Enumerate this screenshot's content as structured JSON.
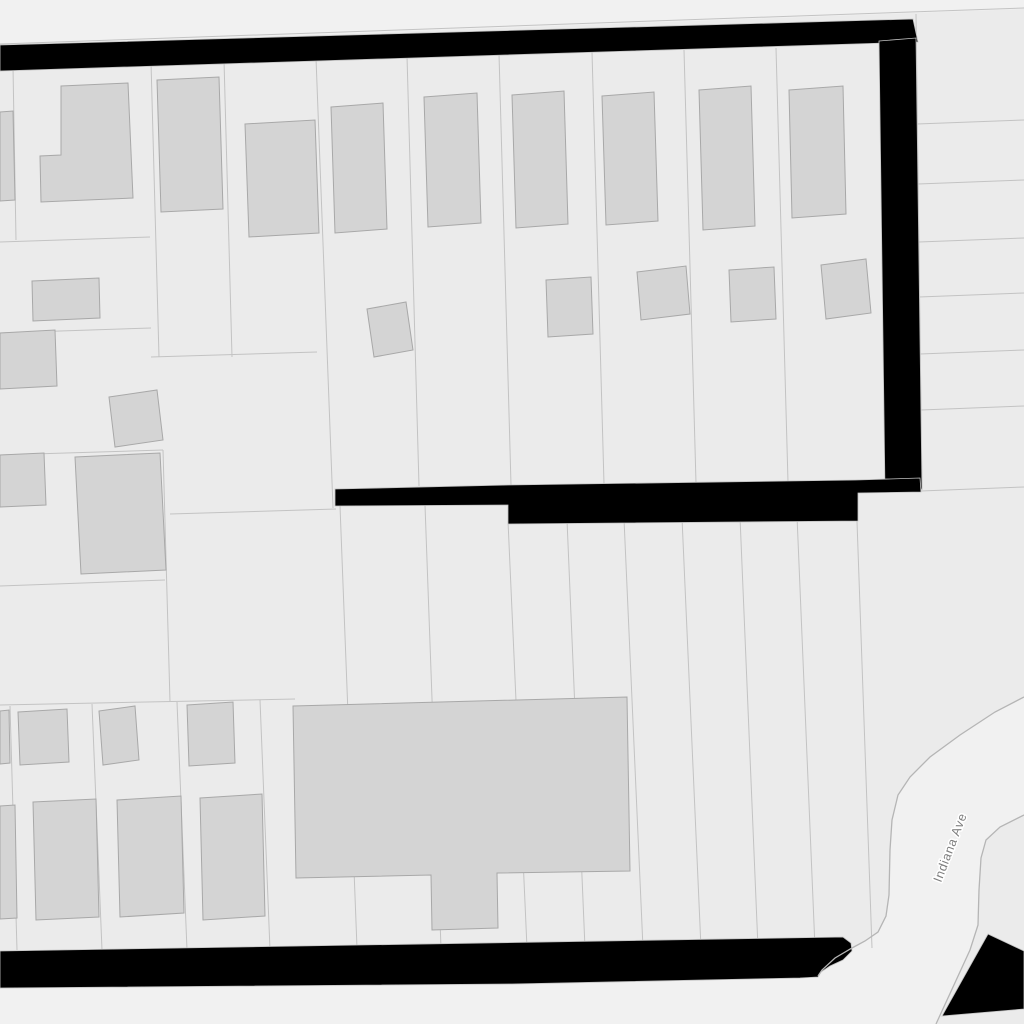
{
  "map": {
    "colors": {
      "background": "#f1f1f1",
      "parcel_fill": "#ebebeb",
      "parcel_line": "#c3c3c3",
      "building_fill": "#d4d4d4",
      "building_line": "#a8a8a8",
      "blocked_fill": "#000000",
      "blocked_edge": "#c3c3c3",
      "road_edge": "#b5b5b5",
      "label_color": "#7e7e7e",
      "label_halo": "#ffffff"
    },
    "street_label": {
      "text": "Indiana Ave",
      "x": 954,
      "y": 849,
      "rotation": -69,
      "font_size": 12.5,
      "letter_spacing": 0.7
    },
    "blocks": [
      {
        "name": "parcel-block-main",
        "points": "0,46 1024,9 1024,697 995,712 960,735 930,757 910,777 898,795 892,820 890,850 889,895 886,916 878,932 865,941 852,948 835,958 822,970 818,976 800,978 512,985 0,989"
      },
      {
        "name": "parcel-block-east-of-road",
        "points": "1024,815 1000,827 986,840 981,858 979,890 978,925 970,950 936,1024 1024,1024"
      }
    ],
    "parcel_lines": [
      "0,44 1024,8",
      "916,14 922,490",
      "917,124 1024,120",
      "918,184 1024,180",
      "919,242 1024,238",
      "919,297 1024,293",
      "920,354 1024,350",
      "921,410 1024,406",
      "921,491 1024,487",
      "13,67 16,240",
      "151,62 159,357",
      "224,60 232,357",
      "316,58 333,508",
      "407,56 419,486",
      "499,54 511,485",
      "592,52 604,484",
      "684,50 696,483",
      "776,48 788,482",
      "0,242 150,237",
      "0,333 151,328",
      "151,357 317,352",
      "0,455 163,450",
      "163,450 170,702",
      "170,514 336,509",
      "0,586 165,580",
      "0,705 295,699",
      "340,506 357,948",
      "425,505 441,948",
      "508,521 527,948",
      "567,520 585,948",
      "624,519 643,948",
      "682,518 701,948",
      "740,517 758,948",
      "797,516 815,948",
      "856,493 872,948",
      "10,706 17,950",
      "92,704 102,950",
      "177,702 187,950",
      "260,700 270,950"
    ],
    "buildings": [
      {
        "name": "building-l-house",
        "points": "61,86 128,83 133,198 41,202 40,156 61,155"
      },
      {
        "name": "building",
        "points": "0,112 13,111 15,200 0,201"
      },
      {
        "name": "building",
        "points": "32,281 99,278 100,318 33,321"
      },
      {
        "name": "building",
        "points": "0,333 55,330 57,386 0,389"
      },
      {
        "name": "building",
        "points": "109,397 157,390 163,440 115,447"
      },
      {
        "name": "building",
        "points": "0,455 44,453 46,505 0,507"
      },
      {
        "name": "building",
        "points": "75,457 160,453 166,570 81,574"
      },
      {
        "name": "building",
        "points": "157,80 219,77 223,209 161,212"
      },
      {
        "name": "building",
        "points": "245,124 315,120 319,233 249,237"
      },
      {
        "name": "building",
        "points": "331,107 383,103 387,229 335,233"
      },
      {
        "name": "building",
        "points": "424,97 477,93 481,223 428,227"
      },
      {
        "name": "building",
        "points": "512,95 564,91 568,224 516,228"
      },
      {
        "name": "building",
        "points": "602,96 654,92 658,221 606,225"
      },
      {
        "name": "building",
        "points": "699,90 751,86 755,226 703,230"
      },
      {
        "name": "building",
        "points": "789,90 843,86 846,214 792,218"
      },
      {
        "name": "building",
        "points": "367,309 406,302 413,350 374,357"
      },
      {
        "name": "building",
        "points": "546,280 591,277 593,334 548,337"
      },
      {
        "name": "building",
        "points": "637,272 686,266 690,314 641,320"
      },
      {
        "name": "building",
        "points": "729,270 774,267 776,319 731,322"
      },
      {
        "name": "building",
        "points": "821,265 866,259 871,313 826,319"
      },
      {
        "name": "building",
        "points": "0,711 9,710 10,763 0,764"
      },
      {
        "name": "building",
        "points": "18,712 67,709 69,762 20,765"
      },
      {
        "name": "building",
        "points": "99,711 135,706 139,760 103,765"
      },
      {
        "name": "building",
        "points": "187,705 233,702 235,763 189,766"
      },
      {
        "name": "building",
        "points": "0,806 15,805 17,918 0,919"
      },
      {
        "name": "building",
        "points": "33,802 96,799 99,917 36,920"
      },
      {
        "name": "building",
        "points": "117,800 181,796 184,913 120,917"
      },
      {
        "name": "building",
        "points": "200,798 262,794 265,916 203,920"
      },
      {
        "name": "building-school",
        "points": "293,706 627,697 630,871 497,873 498,928 432,930 431,875 296,878"
      }
    ],
    "blocked_areas": [
      {
        "name": "blocked-band-top",
        "points": "0,45 913,19 918,42 0,71"
      },
      {
        "name": "blocked-band-vertical",
        "points": "879,41 916,38 922,489 885,491"
      },
      {
        "name": "blocked-band-middle",
        "points": "335,489 508,485 856,480 920,478 921,492 858,493 858,521 508,524 508,505 335,506"
      },
      {
        "name": "blocked-band-bottom",
        "points": "0,951 843,937 851,943 852,951 843,960 830,966 821,972 818,977 800,978 512,984 0,988"
      },
      {
        "name": "blocked-wedge-southeast",
        "points": "988,934 1024,951 1024,1009 942,1016"
      }
    ],
    "road": {
      "edges": [
        {
          "name": "road-edge-west",
          "points": "1024,697 995,712 960,735 930,757 910,777 898,795 892,820 890,850 889,895 886,916 878,932 865,941 852,948 835,958 822,970 818,976"
        },
        {
          "name": "road-edge-east",
          "points": "1024,815 1000,827 986,840 981,858 979,890 978,925 970,950 936,1024"
        }
      ]
    }
  }
}
